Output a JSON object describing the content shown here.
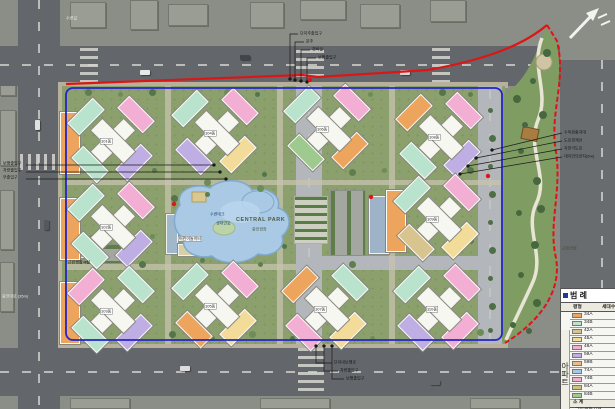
{
  "palette": {
    "orange": "#eda45c",
    "mint": "#b9e3cd",
    "pink": "#f2aed3",
    "purple": "#bfaee3",
    "yellow": "#f3dc9a",
    "tan": "#d8c48e",
    "peach": "#f0b98a",
    "blue": "#a9c6e8",
    "green": "#9ec98f",
    "khaki": "#cfc27a",
    "red_boundary": "#dd1515",
    "blue_boundary": "#2525c8",
    "pond": "#a9c9e5",
    "site_green": "#8ba06c"
  },
  "roads": {
    "top_name": "수변길",
    "left_name": "중앙대로 (35m)"
  },
  "park": {
    "name": "근린공원"
  },
  "central_park": {
    "title": "CENTRAL PARK",
    "subtitle": "중앙광장"
  },
  "pond": {
    "label1": "수변데크",
    "label2": "생태연못"
  },
  "facility": {
    "playground": "어린이놀이터",
    "retail": "근린생활시설"
  },
  "annotations": {
    "left": [
      "보행출입구",
      "차량출입구",
      "부출입구"
    ],
    "top": [
      "단지주출입구",
      "문주",
      "경비실",
      "보행출입구"
    ],
    "right": [
      "수목완충지대",
      "도로경계선",
      "자전거도로",
      "대지안의공지(6m)"
    ],
    "bottom": [
      "단지내보행로",
      "차량출입구",
      "보행출입구"
    ]
  },
  "legend": {
    "title": "범 례",
    "col_type": "평형",
    "col_count": "세대수",
    "group_apartment": "아파트",
    "subtotal": "소 계",
    "rows": [
      {
        "label": "34A",
        "color": "#eda45c"
      },
      {
        "label": "34B",
        "color": "#b9e3cd"
      },
      {
        "label": "42A",
        "color": "#d8c48e"
      },
      {
        "label": "45A",
        "color": "#f3dc9a"
      },
      {
        "label": "48A",
        "color": "#f2aed3"
      },
      {
        "label": "59A",
        "color": "#bfaee3"
      },
      {
        "label": "59B",
        "color": "#f0b98a"
      },
      {
        "label": "74A",
        "color": "#a9c6e8"
      },
      {
        "label": "74B",
        "color": "#f2aed3"
      },
      {
        "label": "84A",
        "color": "#cfc27a"
      },
      {
        "label": "84B",
        "color": "#9ec98f"
      }
    ],
    "extra_rows": [
      {
        "label": "근린생활시설",
        "color": "#eda45c"
      },
      {
        "label": "주민공동시설",
        "color": "#d8c48e"
      }
    ]
  },
  "buildings": [
    {
      "id": "101동",
      "slab": "#eda45c",
      "nw": "#b9e3cd",
      "ne": "#f2aed3",
      "sw": "#b9e3cd",
      "se": "#bfaee3"
    },
    {
      "id": "104동",
      "slab": "",
      "nw": "#b9e3cd",
      "ne": "#f2aed3",
      "sw": "#bfaee3",
      "se": "#f3dc9a"
    },
    {
      "id": "106동",
      "slab": "",
      "nw": "#b9e3cd",
      "ne": "#f2aed3",
      "sw": "#9ec98f",
      "se": "#eda45c"
    },
    {
      "id": "108동",
      "slab": "",
      "nw": "#eda45c",
      "ne": "#f2aed3",
      "sw": "#b9e3cd",
      "se": "#bfaee3"
    },
    {
      "id": "102동",
      "slab": "#eda45c",
      "nw": "#b9e3cd",
      "ne": "#f2aed3",
      "sw": "#b9e3cd",
      "se": "#bfaee3"
    },
    {
      "id": "109동",
      "slab": "#eda45c",
      "nw": "#b9e3cd",
      "ne": "#f2aed3",
      "sw": "#d8c48e",
      "se": "#f3dc9a"
    },
    {
      "id": "103동",
      "slab": "#eda45c",
      "nw": "#f2aed3",
      "ne": "#b9e3cd",
      "sw": "#b9e3cd",
      "se": "#bfaee3"
    },
    {
      "id": "105동",
      "slab": "",
      "nw": "#b9e3cd",
      "ne": "#f2aed3",
      "sw": "#eda45c",
      "se": "#f3dc9a"
    },
    {
      "id": "107동",
      "slab": "",
      "nw": "#eda45c",
      "ne": "#b9e3cd",
      "sw": "#f2aed3",
      "se": "#f3dc9a"
    },
    {
      "id": "110동",
      "slab": "",
      "nw": "#b9e3cd",
      "ne": "#f2aed3",
      "sw": "#bfaee3",
      "se": "#f2aed3"
    }
  ]
}
